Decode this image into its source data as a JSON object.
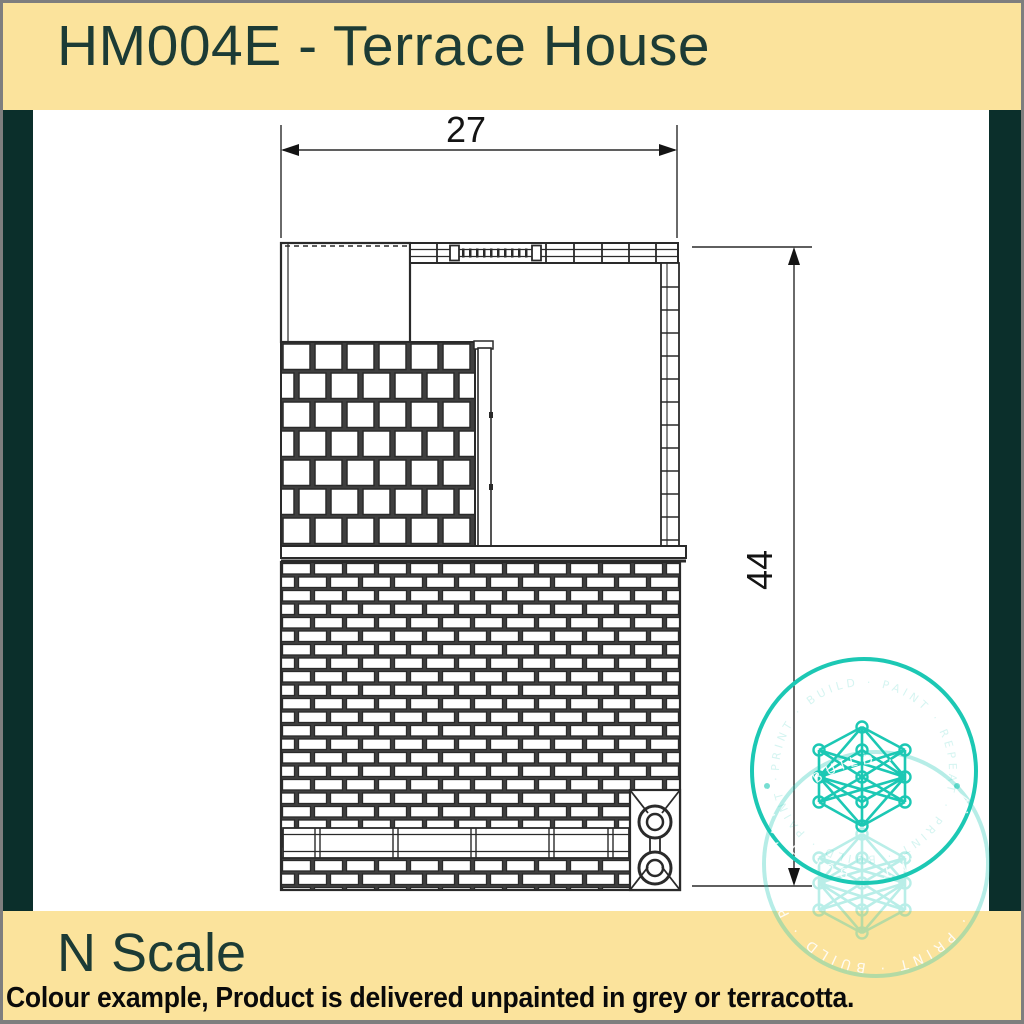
{
  "header": {
    "title": "HM004E - Terrace House"
  },
  "drawing": {
    "width_dimension": "27",
    "height_dimension": "44"
  },
  "footer": {
    "scale_label": "N Scale",
    "note": "Colour example, Product is delivered unpainted in grey or terracotta."
  },
  "watermark": {
    "ring_text": "PRINT · BUILD · PAINT · REPEAT · PRINT · BUILD · PAINT · RE"
  },
  "colors": {
    "banner_yellow": "#FBE39C",
    "sidebar_teal": "#0B2F2B",
    "heading_teal": "#1C3B35",
    "watermark_teal": "#1CC8B4",
    "line_dark": "#2A2A2A",
    "frame_gray": "#7E7E7E"
  }
}
